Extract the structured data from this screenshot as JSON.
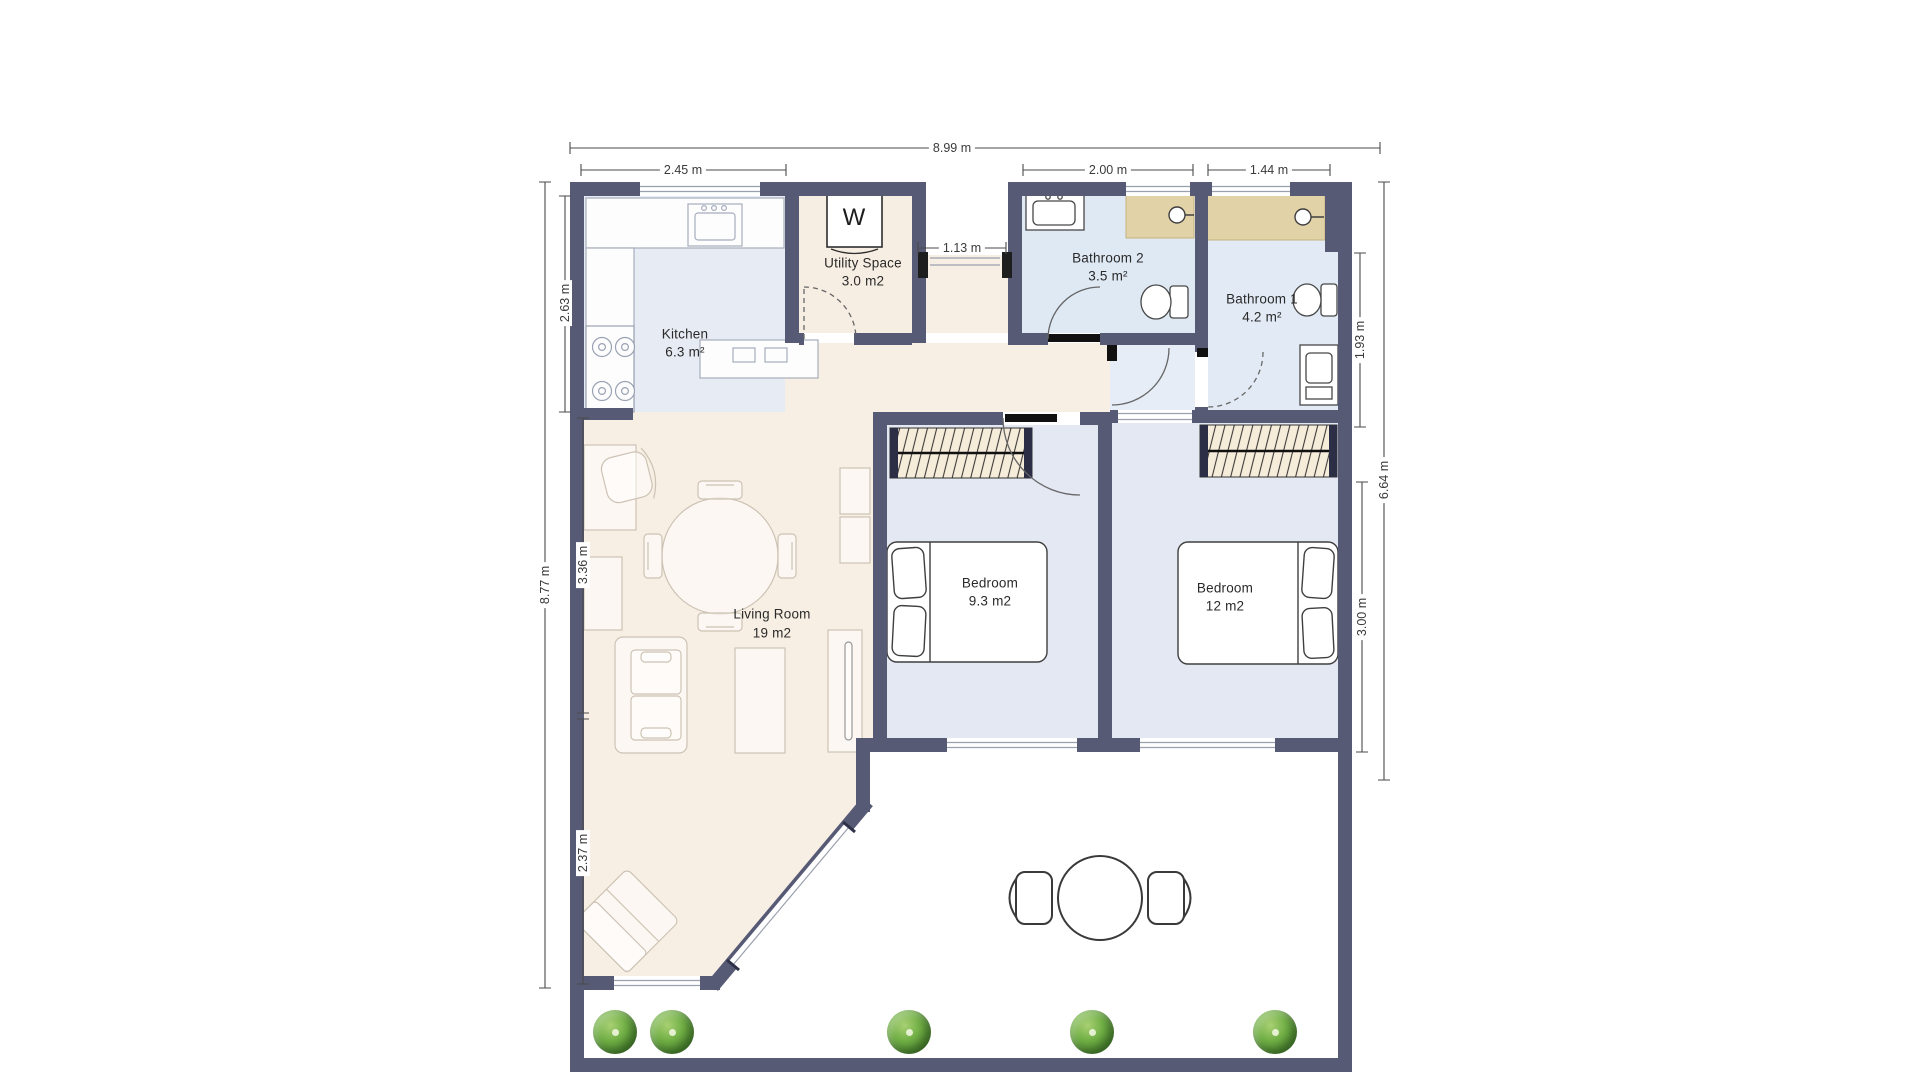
{
  "labels": {
    "kitchen_name": "Kitchen",
    "kitchen_area": "6.3 m²",
    "utility_name": "Utility Space",
    "utility_area": "3.0 m2",
    "bathroom2_name": "Bathroom 2",
    "bathroom2_area": "3.5 m²",
    "bathroom1_name": "Bathroom 1",
    "bathroom1_area": "4.2 m²",
    "living_name": "Living Room",
    "living_area": "19 m2",
    "bedroom1_name": "Bedroom",
    "bedroom1_area": "9.3 m2",
    "bedroom2_name": "Bedroom",
    "bedroom2_area": "12 m2",
    "washer": "W"
  },
  "dims": {
    "overall_width": "8.99 m",
    "kitchen_width": "2.45 m",
    "bathroom2_width": "2.00 m",
    "bathroom1_width": "1.44 m",
    "entry_opening": "1.13 m",
    "kitchen_height": "2.63 m",
    "left_total": "8.77 m",
    "living_mid": "3.36 m",
    "living_lower": "2.37 m",
    "bathroom1_height": "1.93 m",
    "right_total": "6.64 m",
    "bedroom_height": "3.00 m"
  },
  "colors": {
    "wall": "#575a74",
    "living_floor": "#f8efe4",
    "kitchen_floor": "#e7ebf3",
    "bedroom_floor": "#e4e8f2",
    "bathroom_floor": "#dfe9f4",
    "shower": "#e2d2a8",
    "wardrobe": "#f6ecda",
    "tree_green": "#5a9c3a",
    "dimension_line": "#4a4a4a"
  }
}
